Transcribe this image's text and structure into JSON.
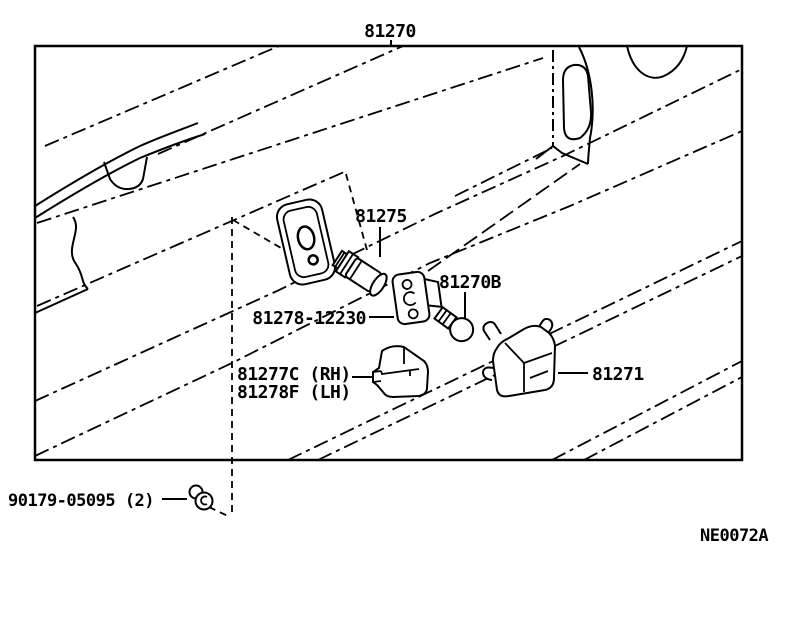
{
  "figure": {
    "labels": {
      "assembly": "81270",
      "socket": "81275",
      "bulb": "81270B",
      "retainer": "81278-12230",
      "cover_rh": "81277C (RH)",
      "cover_lh": "81278F (LH)",
      "lens": "81271",
      "nut": "90179-05095 (2)",
      "figure_code": "NE0072A"
    },
    "colors": {
      "ink": "#000000",
      "paper": "#ffffff"
    }
  }
}
